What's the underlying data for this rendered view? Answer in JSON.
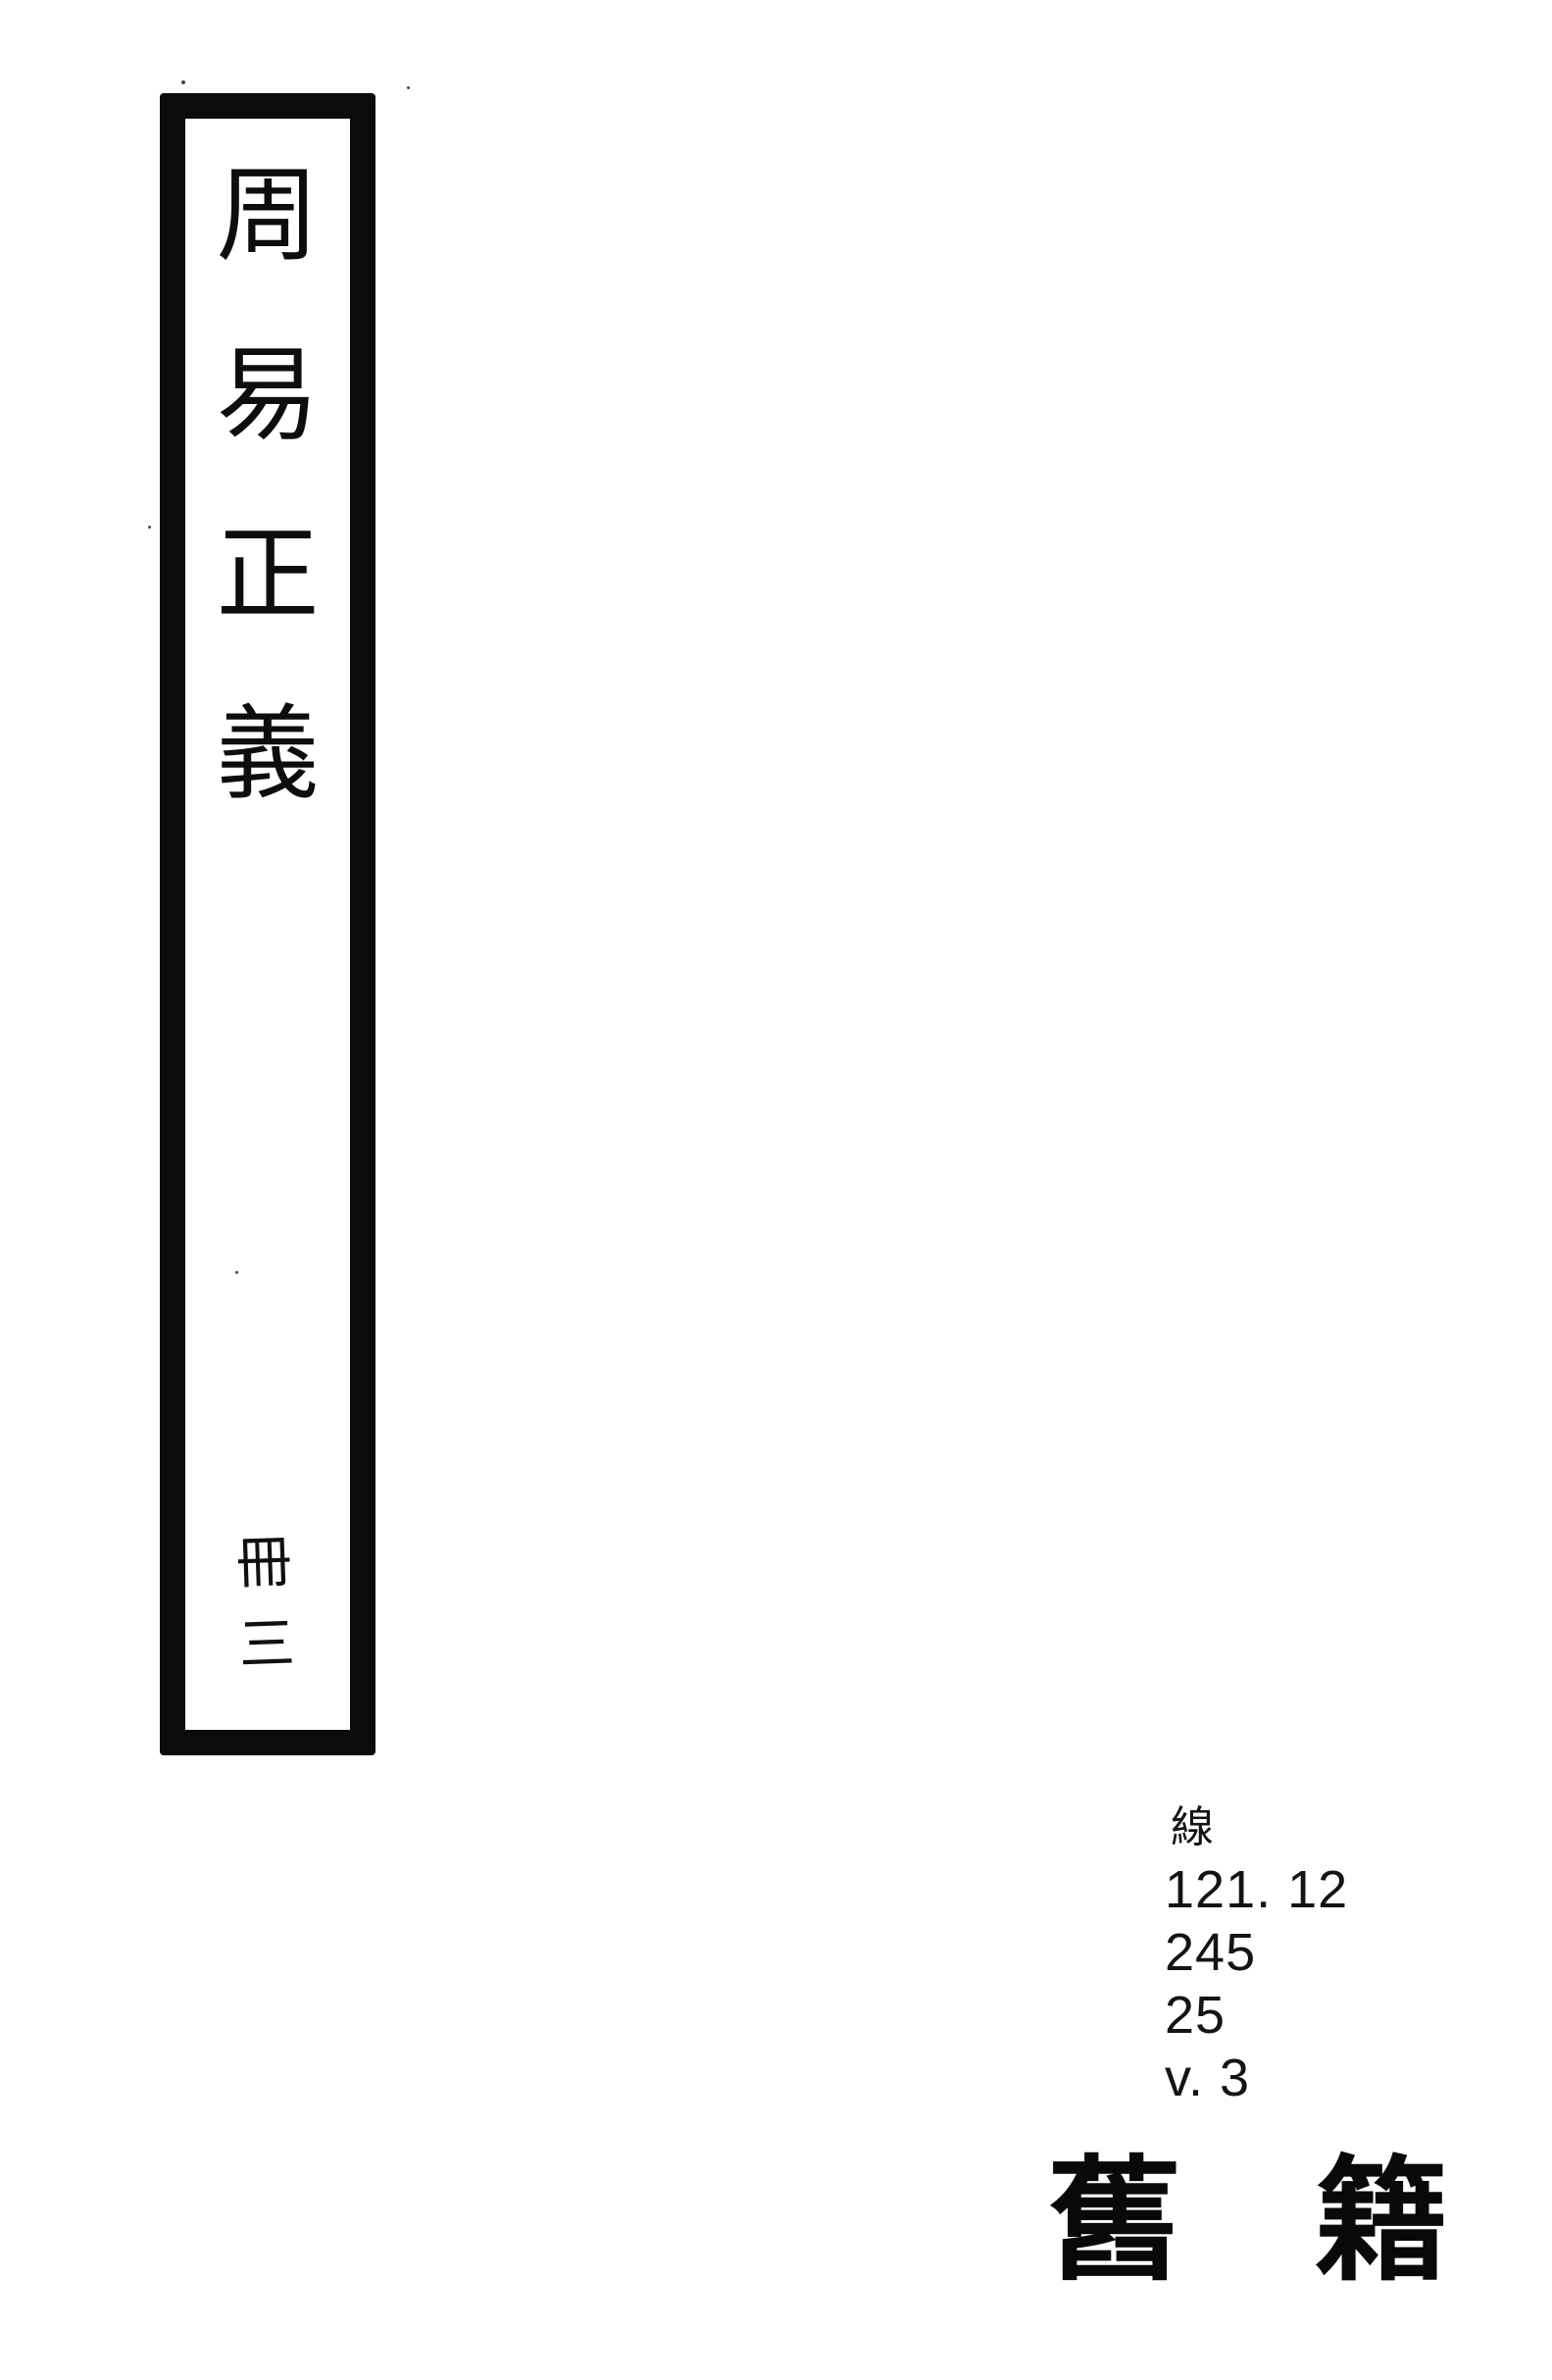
{
  "page": {
    "background": "#ffffff",
    "ink_color": "#0b0b0b"
  },
  "spine_label": {
    "title": "周易正義",
    "title_chars": [
      "周",
      "易",
      "正",
      "義"
    ],
    "volume": "冊三",
    "volume_chars": [
      "冊",
      "三"
    ]
  },
  "call_number": {
    "lines": [
      "線",
      "121. 12",
      "245",
      "25",
      "v. 3"
    ]
  },
  "category_mark": {
    "text": "舊籍",
    "chars": [
      "舊",
      "籍"
    ]
  }
}
